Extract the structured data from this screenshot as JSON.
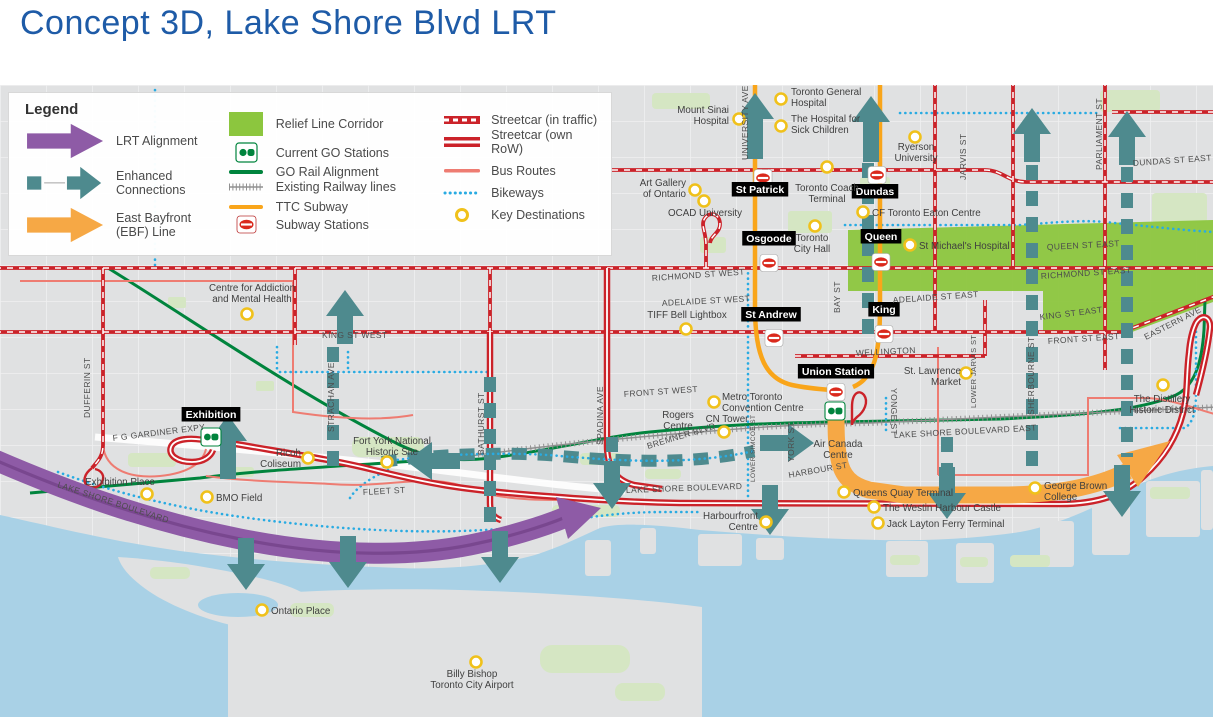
{
  "title": "Concept 3D, Lake Shore Blvd LRT",
  "colors": {
    "title_blue": "#1E5BA7",
    "lrt_purple": "#8E5BA6",
    "enhanced_teal": "#4E8A8E",
    "ebf_orange": "#F6A845",
    "relief_green": "#8CC63E",
    "go_green": "#00843D",
    "subway_orange": "#F9A51A",
    "streetcar_red": "#CB2229",
    "bus_salmon": "#EE7C72",
    "bikeway_blue": "#29ABE2",
    "key_destination_yellow": "#F0C11B",
    "water": "#A9D1E6",
    "land": "#E0E1E2"
  },
  "legend": {
    "title": "Legend",
    "alignment": [
      {
        "label": "LRT Alignment"
      },
      {
        "label": "Enhanced Connections"
      },
      {
        "label": "East Bayfront (EBF) Line"
      }
    ],
    "infrastructure": [
      {
        "label": "Relief Line Corridor"
      },
      {
        "label": "Current GO Stations"
      },
      {
        "label": "GO Rail Alignment"
      },
      {
        "label": "Existing Railway lines"
      },
      {
        "label": "TTC Subway"
      },
      {
        "label": "Subway Stations"
      }
    ],
    "surface": [
      {
        "label": "Streetcar (in traffic)"
      },
      {
        "label": "Streetcar (own RoW)"
      },
      {
        "label": "Bus Routes"
      },
      {
        "label": "Bikeways"
      },
      {
        "label": "Key Destinations"
      }
    ]
  },
  "map": {
    "stations": [
      {
        "id": "st-patrick",
        "label": "St Patrick",
        "icon": "ttc",
        "ix": 763,
        "iy": 93,
        "lx": 760,
        "ly": 108
      },
      {
        "id": "dundas",
        "label": "Dundas",
        "icon": "ttc",
        "ix": 877,
        "iy": 90,
        "lx": 875,
        "ly": 110
      },
      {
        "id": "osgoode",
        "label": "Osgoode",
        "icon": "ttc",
        "ix": 769,
        "iy": 178,
        "lx": 769,
        "ly": 157
      },
      {
        "id": "queen",
        "label": "Queen",
        "icon": "ttc",
        "ix": 881,
        "iy": 177,
        "lx": 881,
        "ly": 155
      },
      {
        "id": "st-andrew",
        "label": "St Andrew",
        "icon": "ttc",
        "ix": 774,
        "iy": 253,
        "lx": 771,
        "ly": 233
      },
      {
        "id": "king",
        "label": "King",
        "icon": "ttc",
        "ix": 884,
        "iy": 249,
        "lx": 884,
        "ly": 228
      },
      {
        "id": "union",
        "label": "Union Station",
        "icon": "ttc",
        "ix": 836,
        "iy": 307,
        "lx": 836,
        "ly": 290,
        "go_x": 835,
        "go_y": 326
      },
      {
        "id": "exhibition",
        "label": "Exhibition",
        "icon": "go",
        "ix": 211,
        "iy": 352,
        "lx": 211,
        "ly": 333
      }
    ],
    "destinations": [
      {
        "lines": [
          "Mount Sinai",
          "Hospital"
        ],
        "cx": 739,
        "cy": 34,
        "circle": true,
        "anchor": "end",
        "lx": 729,
        "ly": 28
      },
      {
        "lines": [
          "Toronto General",
          "Hospital"
        ],
        "cx": 781,
        "cy": 14,
        "circle": true,
        "anchor": "start",
        "lx": 791,
        "ly": 10
      },
      {
        "lines": [
          "The Hospital for",
          "Sick Children"
        ],
        "cx": 781,
        "cy": 41,
        "circle": true,
        "anchor": "start",
        "lx": 791,
        "ly": 37
      },
      {
        "lines": [
          "Ryerson",
          "University"
        ],
        "cx": 915,
        "cy": 52,
        "circle": true,
        "anchor": "middle",
        "lx": 916,
        "ly": 65
      },
      {
        "lines": [
          "Art Gallery",
          "of Ontario"
        ],
        "cx": 695,
        "cy": 105,
        "circle": true,
        "anchor": "end",
        "lx": 686,
        "ly": 101
      },
      {
        "lines": [
          "OCAD University"
        ],
        "cx": 704,
        "cy": 116,
        "circle": true,
        "anchor": "start",
        "lx": 668,
        "ly": 131
      },
      {
        "lines": [
          "Toronto Coach",
          "Terminal"
        ],
        "cx": 827,
        "cy": 82,
        "circle": true,
        "anchor": "middle",
        "lx": 827,
        "ly": 106
      },
      {
        "lines": [
          "CF Toronto Eaton Centre"
        ],
        "cx": 863,
        "cy": 127,
        "circle": true,
        "anchor": "start",
        "lx": 872,
        "ly": 131
      },
      {
        "lines": [
          "Toronto",
          "City Hall"
        ],
        "cx": 815,
        "cy": 141,
        "circle": true,
        "anchor": "middle",
        "lx": 812,
        "ly": 156
      },
      {
        "lines": [
          "St Michael's Hospital"
        ],
        "cx": 910,
        "cy": 160,
        "circle": true,
        "anchor": "start",
        "lx": 919,
        "ly": 164
      },
      {
        "lines": [
          "Centre for Addiction",
          "and Mental Health"
        ],
        "cx": 247,
        "cy": 229,
        "circle": true,
        "anchor": "middle",
        "lx": 252,
        "ly": 206
      },
      {
        "lines": [
          "TIFF Bell Lightbox"
        ],
        "cx": 686,
        "cy": 244,
        "circle": true,
        "anchor": "middle",
        "lx": 687,
        "ly": 233
      },
      {
        "lines": [
          "Metro Toronto",
          "Convention Centre"
        ],
        "cx": 714,
        "cy": 317,
        "circle": true,
        "anchor": "start",
        "lx": 722,
        "ly": 315
      },
      {
        "lines": [
          "Rogers",
          "Centre"
        ],
        "cx": 678,
        "cy": 340,
        "circle": false,
        "anchor": "middle",
        "lx": 678,
        "ly": 333
      },
      {
        "lines": [
          "CN Tower"
        ],
        "cx": 724,
        "cy": 347,
        "circle": true,
        "anchor": "middle",
        "lx": 727,
        "ly": 337
      },
      {
        "lines": [
          "Air Canada",
          "Centre"
        ],
        "cx": 838,
        "cy": 360,
        "circle": false,
        "anchor": "middle",
        "lx": 838,
        "ly": 362
      },
      {
        "lines": [
          "St. Lawrence",
          "Market"
        ],
        "cx": 966,
        "cy": 288,
        "circle": true,
        "anchor": "end",
        "lx": 961,
        "ly": 289
      },
      {
        "lines": [
          "Exhibition Place"
        ],
        "cx": 147,
        "cy": 409,
        "circle": true,
        "anchor": "middle",
        "lx": 120,
        "ly": 400
      },
      {
        "lines": [
          "BMO Field"
        ],
        "cx": 207,
        "cy": 412,
        "circle": true,
        "anchor": "start",
        "lx": 216,
        "ly": 416
      },
      {
        "lines": [
          "Ricoh",
          "Coliseum"
        ],
        "cx": 308,
        "cy": 373,
        "circle": true,
        "anchor": "end",
        "lx": 301,
        "ly": 371
      },
      {
        "lines": [
          "Fort York National",
          "Historic Site"
        ],
        "cx": 387,
        "cy": 377,
        "circle": true,
        "anchor": "middle",
        "lx": 392,
        "ly": 359
      },
      {
        "lines": [
          "Ontario Place"
        ],
        "cx": 262,
        "cy": 525,
        "circle": true,
        "anchor": "start",
        "lx": 271,
        "ly": 529
      },
      {
        "lines": [
          "Billy Bishop",
          "Toronto City Airport"
        ],
        "cx": 476,
        "cy": 577,
        "circle": true,
        "anchor": "middle",
        "lx": 472,
        "ly": 592
      },
      {
        "lines": [
          "Harbourfront",
          "Centre"
        ],
        "cx": 766,
        "cy": 437,
        "circle": true,
        "anchor": "end",
        "lx": 758,
        "ly": 434
      },
      {
        "lines": [
          "Queens Quay Terminal"
        ],
        "cx": 844,
        "cy": 407,
        "circle": true,
        "anchor": "start",
        "lx": 853,
        "ly": 411
      },
      {
        "lines": [
          "The Westin Harbour Castle"
        ],
        "cx": 874,
        "cy": 422,
        "circle": true,
        "anchor": "start",
        "lx": 883,
        "ly": 426
      },
      {
        "lines": [
          "Jack Layton Ferry Terminal"
        ],
        "cx": 878,
        "cy": 438,
        "circle": true,
        "anchor": "start",
        "lx": 887,
        "ly": 442
      },
      {
        "lines": [
          "George Brown",
          "College"
        ],
        "cx": 1035,
        "cy": 403,
        "circle": true,
        "anchor": "start",
        "lx": 1044,
        "ly": 404
      },
      {
        "lines": [
          "The Distillery",
          "Historic District"
        ],
        "cx": 1163,
        "cy": 300,
        "circle": true,
        "anchor": "middle",
        "lx": 1162,
        "ly": 317
      }
    ],
    "streets": [
      {
        "text": "UNIVERSITY AVE",
        "x": 748,
        "y": 75,
        "r": -90
      },
      {
        "text": "JARVIS ST",
        "x": 966,
        "y": 95,
        "r": -90
      },
      {
        "text": "PARLIAMENT ST",
        "x": 1102,
        "y": 85,
        "r": -90
      },
      {
        "text": "BAY ST",
        "x": 840,
        "y": 228,
        "r": -90
      },
      {
        "text": "YONGE ST",
        "x": 891,
        "y": 303,
        "r": 90
      },
      {
        "text": "LOWER JARVIS ST",
        "x": 976,
        "y": 323,
        "r": -90,
        "s": 7.5
      },
      {
        "text": "SHERBOURNE ST",
        "x": 1034,
        "y": 330,
        "r": -90
      },
      {
        "text": "DUFFERIN ST",
        "x": 90,
        "y": 333,
        "r": -90
      },
      {
        "text": "STRACHAN AVE",
        "x": 334,
        "y": 347,
        "r": -90
      },
      {
        "text": "BATHURST ST",
        "x": 484,
        "y": 370,
        "r": -90
      },
      {
        "text": "SPADINA AVE",
        "x": 603,
        "y": 360,
        "r": -90
      },
      {
        "text": "LOWER SIMCOE ST",
        "x": 755,
        "y": 397,
        "r": -90,
        "s": 6.5
      },
      {
        "text": "YORK ST",
        "x": 794,
        "y": 377,
        "r": -90
      },
      {
        "text": "KING ST WEST",
        "x": 322,
        "y": 253,
        "r": 0
      },
      {
        "text": "KING ST EAST",
        "x": 1040,
        "y": 235,
        "r": -7
      },
      {
        "text": "DUNDAS ST EAST",
        "x": 1133,
        "y": 81,
        "r": -4
      },
      {
        "text": "QUEEN ST EAST",
        "x": 1047,
        "y": 165,
        "r": -3
      },
      {
        "text": "RICHMOND ST WEST",
        "x": 652,
        "y": 196,
        "r": -4
      },
      {
        "text": "RICHMOND ST EAST",
        "x": 1041,
        "y": 194,
        "r": -4
      },
      {
        "text": "ADELAIDE ST WEST",
        "x": 662,
        "y": 221,
        "r": -3
      },
      {
        "text": "ADELAIDE ST EAST",
        "x": 893,
        "y": 218,
        "r": -4
      },
      {
        "text": "WELLINGTON",
        "x": 856,
        "y": 271,
        "r": -3
      },
      {
        "text": "FRONT ST WEST",
        "x": 624,
        "y": 312,
        "r": -4
      },
      {
        "text": "FRONT ST EAST",
        "x": 1048,
        "y": 259,
        "r": -4
      },
      {
        "text": "EASTERN AVE",
        "x": 1146,
        "y": 255,
        "r": -27
      },
      {
        "text": "F G GARDINER EXPY",
        "x": 113,
        "y": 356,
        "r": -7
      },
      {
        "text": "LAKE SHORE BOULEVARD",
        "x": 57,
        "y": 402,
        "r": 18
      },
      {
        "text": "FLEET ST",
        "x": 363,
        "y": 410,
        "r": -3
      },
      {
        "text": "BREMNER BLVD",
        "x": 648,
        "y": 364,
        "r": -17
      },
      {
        "text": "LAKE SHORE BOULEVARD",
        "x": 626,
        "y": 408,
        "r": -2
      },
      {
        "text": "HARBOUR ST",
        "x": 789,
        "y": 393,
        "r": -10
      },
      {
        "text": "LAKE SHORE BOULEVARD EAST",
        "x": 894,
        "y": 353,
        "r": -3
      }
    ]
  }
}
